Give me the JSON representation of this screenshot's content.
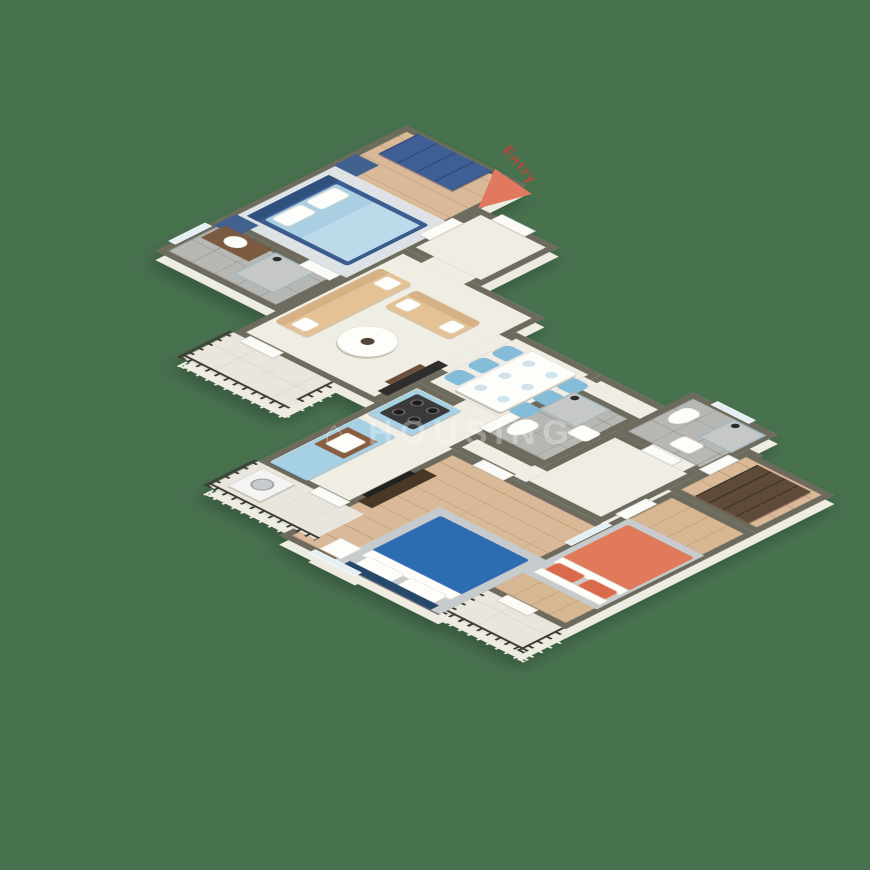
{
  "scene": {
    "type": "isometric-3d-floor-plan",
    "background_color": "#48714e",
    "entry_label": "Entry",
    "entry_arrow_color": "#e0795f",
    "watermark_glyph": "⌂",
    "watermark_text": "HOUSING",
    "palette": {
      "wall_top": "#6c6b5d",
      "wall_face": "#f7f4eb",
      "wood_floor": "#d9b997",
      "marble_floor": "#f0ede4",
      "bath_tile": "#b7b8b4",
      "balcony_floor": "#e9e6dd",
      "railing": "#3e3c37",
      "master_bed_frame": "#3a5c8f",
      "master_bedding": "#aacfe3",
      "bedroom2_bed": "#2d6cb0",
      "bedroom3_bed": "#e07a5b",
      "sofa": "#e5c295",
      "kitchen_cabinets": "#a6d0e4",
      "wardrobe_blue": "#3d5f95",
      "wardrobe_brown": "#5d4a39",
      "dining_chairs": "#85bcd9"
    },
    "rooms": [
      {
        "name": "master-bedroom",
        "floor": "wood"
      },
      {
        "name": "master-bathroom",
        "floor": "tile"
      },
      {
        "name": "foyer",
        "floor": "marble"
      },
      {
        "name": "living-room",
        "floor": "marble"
      },
      {
        "name": "dining-area",
        "floor": "marble"
      },
      {
        "name": "kitchen",
        "floor": "marble"
      },
      {
        "name": "common-bathroom",
        "floor": "tile"
      },
      {
        "name": "corridor",
        "floor": "marble"
      },
      {
        "name": "bathroom-3",
        "floor": "tile"
      },
      {
        "name": "dressing-area",
        "floor": "wood"
      },
      {
        "name": "bedroom-2",
        "floor": "wood"
      },
      {
        "name": "bedroom-3",
        "floor": "wood"
      },
      {
        "name": "living-balcony",
        "floor": "balcony"
      },
      {
        "name": "utility-balcony",
        "floor": "balcony"
      },
      {
        "name": "bedroom-balcony",
        "floor": "balcony"
      }
    ],
    "furniture": [
      "blue-wardrobe",
      "master-double-bed",
      "nightstands",
      "vanity-sink",
      "shower",
      "sofa-long",
      "sofa-short",
      "round-coffee-table",
      "tv-unit",
      "dining-table-6-seater",
      "blue-chairs",
      "plates",
      "kitchen-sink-counter",
      "gas-stove-counter",
      "washing-machine",
      "toilet",
      "wash-basin",
      "brown-wardrobe",
      "bedroom2-blue-bed",
      "bedroom2-tv-console",
      "bedroom3-orange-bed",
      "rugs"
    ]
  }
}
